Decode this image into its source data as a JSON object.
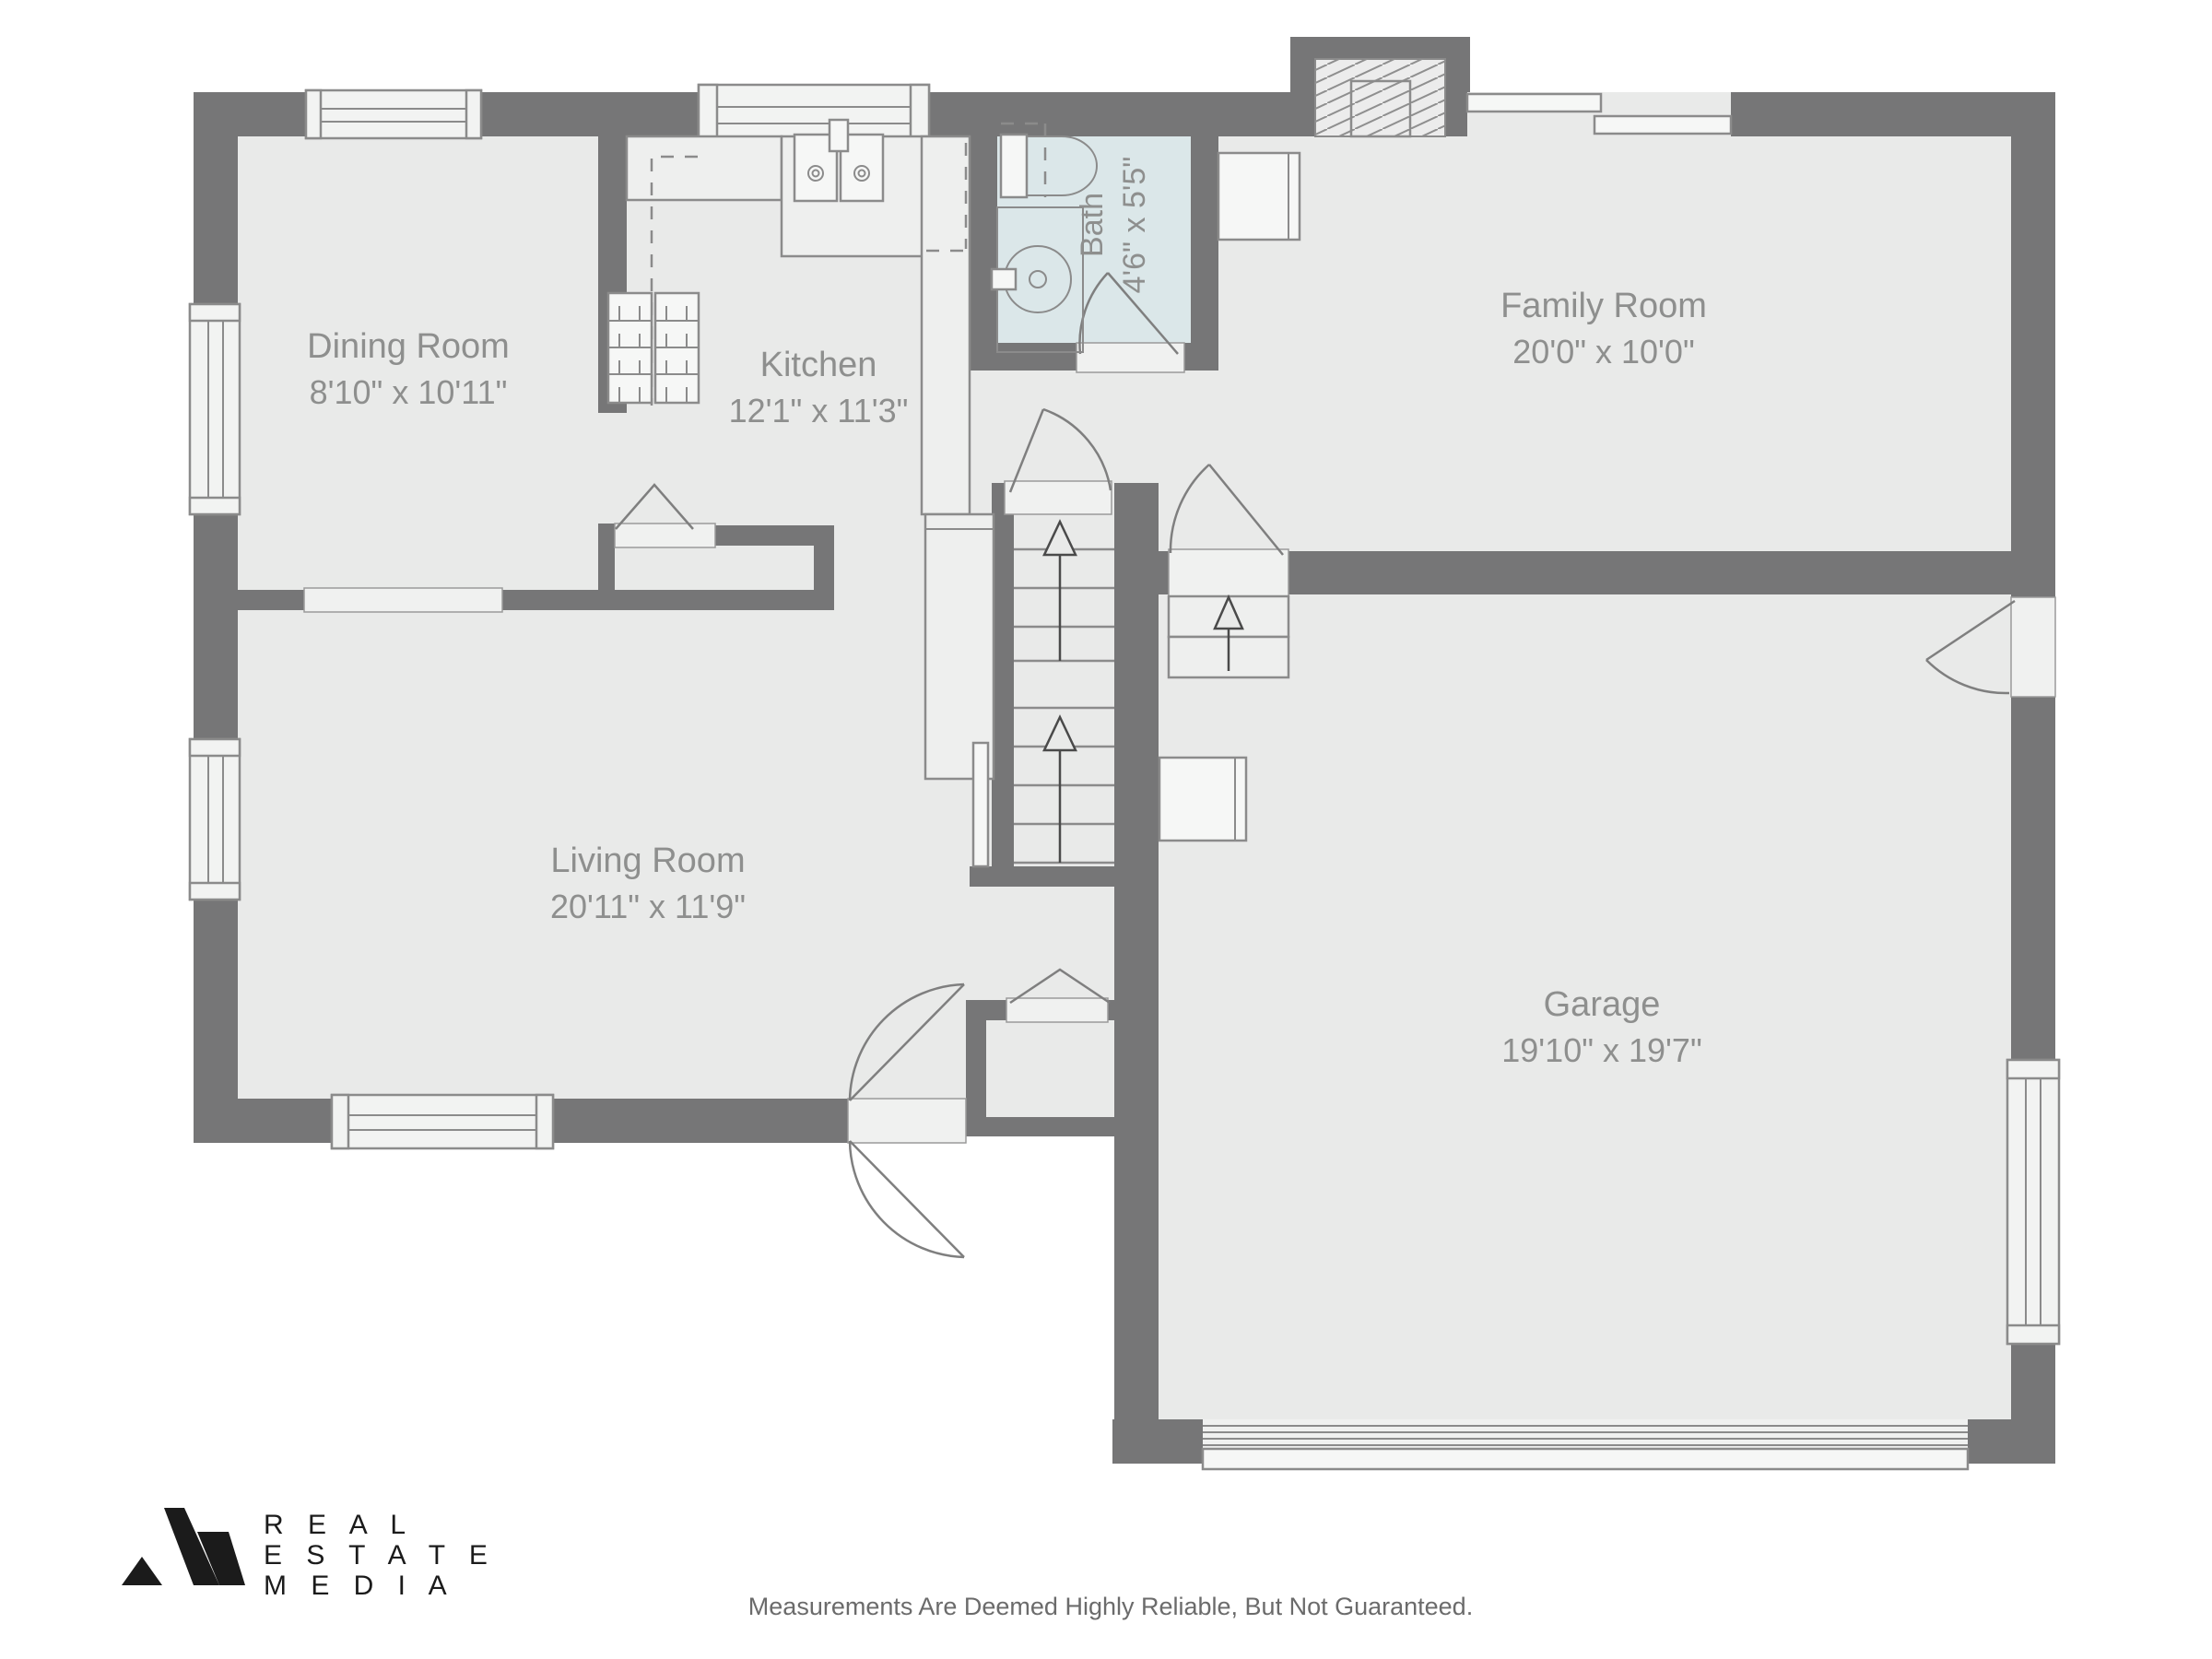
{
  "plan": {
    "title": "First floor plan",
    "rooms": [
      {
        "id": "dining",
        "name": "Dining Room",
        "dims": "8'10\" x 10'11\""
      },
      {
        "id": "kitchen",
        "name": "Kitchen",
        "dims": "12'1\" x 11'3\""
      },
      {
        "id": "bath",
        "name": "Bath",
        "dims": "4'6\" x 5'5\""
      },
      {
        "id": "family",
        "name": "Family Room",
        "dims": "20'0\" x 10'0\""
      },
      {
        "id": "living",
        "name": "Living Room",
        "dims": "20'11\" x 11'9\""
      },
      {
        "id": "garage",
        "name": "Garage",
        "dims": "19'10\" x 19'7\""
      }
    ],
    "colors": {
      "wall": "#767677",
      "floor": "#e9eae9",
      "bath_floor": "#dbe7e9",
      "line": "#8b8b8b",
      "label_text": "#8e8f8e",
      "logo_black": "#1b1b1b"
    }
  },
  "branding": {
    "logo_lines": [
      "R E A L",
      "E S T A T E",
      "M E D I A"
    ]
  },
  "footer": {
    "disclaimer": "Measurements Are Deemed Highly Reliable, But Not Guaranteed."
  }
}
